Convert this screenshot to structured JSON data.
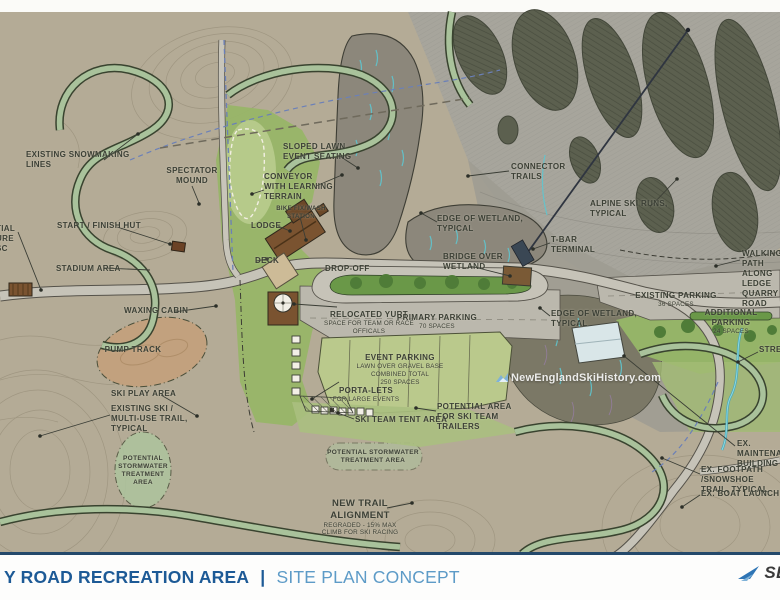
{
  "map": {
    "labels": {
      "snowmaking": "EXISTING SNOWMAKING\nLINES",
      "spectator_mound": "SPECTATOR\nMOUND",
      "start_finish_hut": "START / FINISH HUT",
      "stadium_area": "STADIUM AREA",
      "left_edge_partial": "TIAL\nURE\nSC",
      "waxing_cabin": "WAXING CABIN",
      "pump_track": "PUMP TRACK",
      "ski_play_area": "SKI PLAY AREA",
      "existing_ski_trail": "EXISTING SKI /\nMULTI-USE TRAIL,\nTYPICAL",
      "stormwater_left": "POTENTIAL\nSTORMWATER\nTREATMENT\nAREA",
      "sloped_lawn": "SLOPED LAWN\nEVENT SEATING",
      "conveyor": "CONVEYOR\nWITH LEARNING\nTERRAIN",
      "bike_station": "BIKE FIX/WASH\nSTATION",
      "lodge": "LODGE",
      "deck": "DECK",
      "drop_off": "DROP-OFF",
      "relocated_yurt": "RELOCATED YURT",
      "relocated_yurt_sub": "SPACE FOR TEAM OR RACE\nOFFICALS",
      "primary_parking": "PRIMARY PARKING",
      "primary_parking_sub": "70 SPACES",
      "bridge_over_wetland": "BRIDGE OVER\nWETLAND",
      "event_parking": "EVENT PARKING",
      "event_parking_sub": "LAWN OVER GRAVEL BASE\nCOMBINED TOTAL\n250 SPACES",
      "porta_lets": "PORTA-LETS",
      "porta_lets_sub": "FOR LARGE EVENTS",
      "ski_team_tent": "SKI TEAM TENT AREA",
      "ski_team_trailers": "POTENTIAL AREA\nFOR SKI TEAM\nTRAILERS",
      "stormwater_center": "POTENTIAL STORMWATER\nTREATMENT AREA",
      "new_trail": "NEW TRAIL\nALIGNMENT",
      "new_trail_sub": "REGRADED - 15% MAX\nCLIMB FOR SKI RACING",
      "edge_wetland_north": "EDGE OF WETLAND,\nTYPICAL",
      "connector_trails": "CONNECTOR\nTRAILS",
      "alpine_runs": "ALPINE SKI RUNS,\nTYPICAL",
      "tbar_terminal": "T-BAR\nTERMINAL",
      "walking_path": "WALKING PATH\nALONG LEDGE\nQUARRY ROAD",
      "existing_parking": "EXISTING PARKING",
      "existing_parking_sub": "36 SPACES",
      "additional_parking": "ADDITIONAL PARKING",
      "additional_parking_sub": "24 SPACES",
      "edge_wetland_south": "EDGE OF WETLAND,\nTYPICAL",
      "stream": "STREAM",
      "ex_maintenance": "EX. MAINTENANCE\nBUILDING",
      "ex_footpath": "EX. FOOTPATH /SNOWSHOE\nTRAIL, TYPICAL",
      "ex_boat_launch": "EX. BOAT LAUNCH"
    },
    "watermark": "NewEnglandSkiHistory.com"
  },
  "footer": {
    "title_primary": "Y ROAD RECREATION AREA",
    "separator": "|",
    "title_secondary": "SITE PLAN CONCEPT",
    "logo_text": "SE"
  },
  "colors": {
    "footer_primary": "#1d5a96",
    "footer_secondary": "#5d9bc7",
    "logo_blue": "#2e75b5",
    "terrain_base": "#b4ab96",
    "lawn_green": "#98b567",
    "label_ink": "#3c4036"
  }
}
